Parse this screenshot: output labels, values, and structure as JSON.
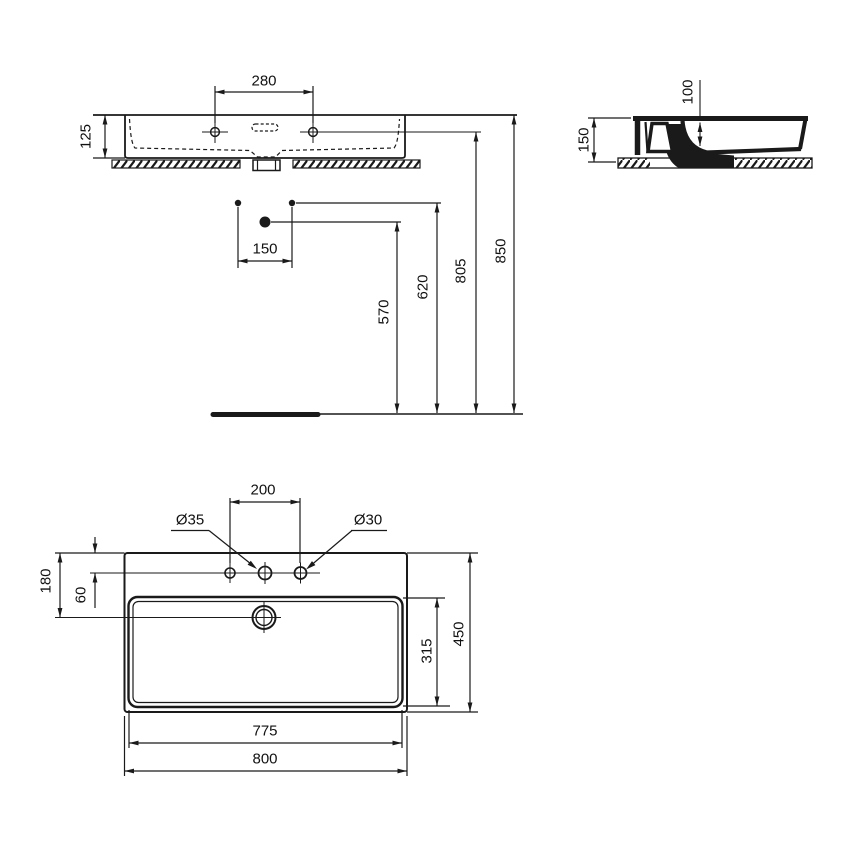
{
  "drawing": {
    "type": "technical-dimension-drawing",
    "subject": "wall-hung rectangular washbasin, three orthographic views",
    "line_color": "#1a1a1a",
    "background": "#ffffff"
  },
  "views": {
    "front": {
      "name": "front elevation with installation heights",
      "dim_tap_hole_spacing": "280",
      "dim_apron_height": "125",
      "dim_fixing_spacing": "150",
      "dim_trap_height": "570",
      "dim_outlet_height": "620",
      "dim_tap_hole_height": "805",
      "dim_rim_height": "850"
    },
    "side": {
      "name": "side section",
      "dim_total_depth": "150",
      "dim_inner_depth": "100"
    },
    "plan": {
      "name": "plan view",
      "dim_tap_hole_spacing": "200",
      "dia_center_hole": "Ø35",
      "dia_side_hole": "Ø30",
      "dim_edge_to_drain": "180",
      "dim_edge_to_holes": "60",
      "dim_bowl_depth": "315",
      "dim_total_depth": "450",
      "dim_bowl_width": "775",
      "dim_total_width": "800"
    }
  }
}
